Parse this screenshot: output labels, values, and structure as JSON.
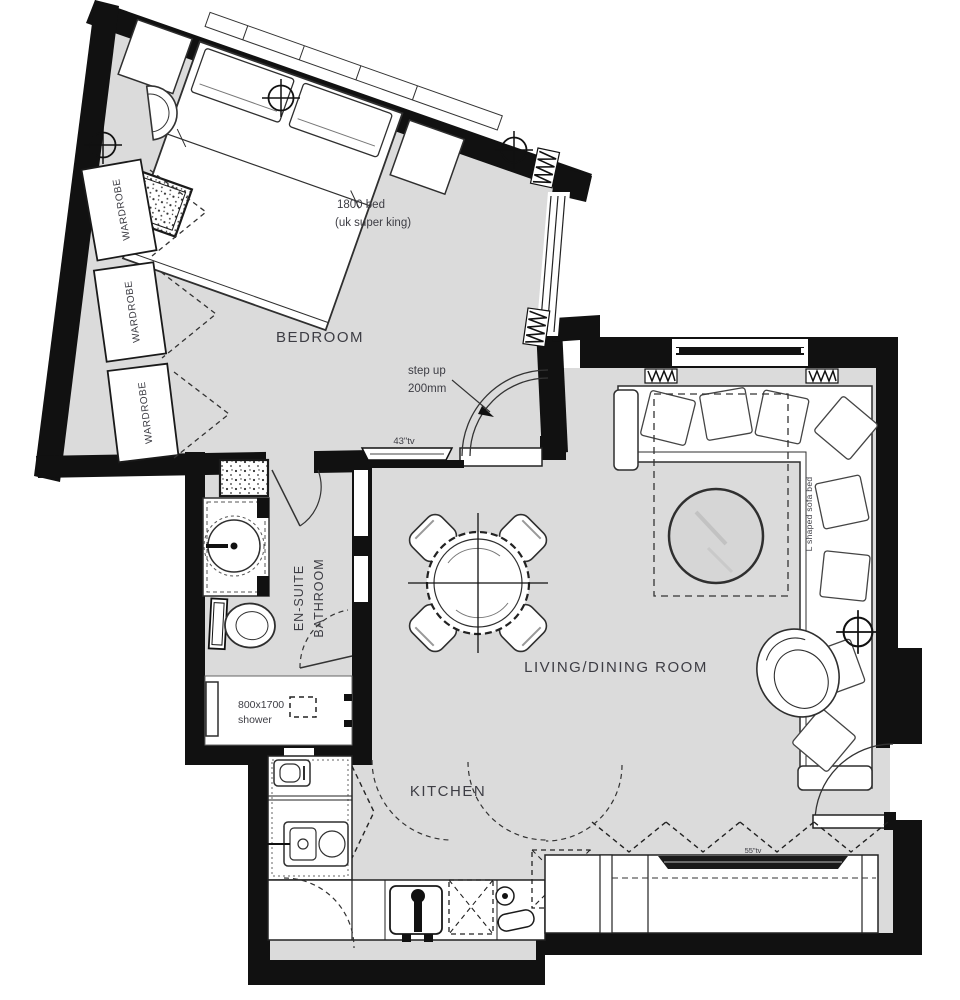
{
  "rooms": {
    "bedroom": {
      "label": "BEDROOM"
    },
    "ensuite": {
      "line1": "EN-SUITE",
      "line2": "BATHROOM"
    },
    "living": {
      "label": "LIVING/DINING ROOM"
    },
    "kitchen": {
      "label": "KITCHEN"
    }
  },
  "annotations": {
    "bed": {
      "line1": "1800 bed",
      "line2": "(uk super king)"
    },
    "wardrobe": "WARDROBE",
    "step": {
      "line1": "step up",
      "line2": "200mm"
    },
    "bedroom_tv": "43\"tv",
    "shower": {
      "line1": "800x1700",
      "line2": "shower"
    },
    "sofa": "L shaped sofa bed",
    "living_tv": "55\"tv"
  },
  "colors": {
    "floor": "#dbdbdb",
    "wall": "#111111",
    "line": "#2f2f2f",
    "text": "#3d3d44"
  }
}
